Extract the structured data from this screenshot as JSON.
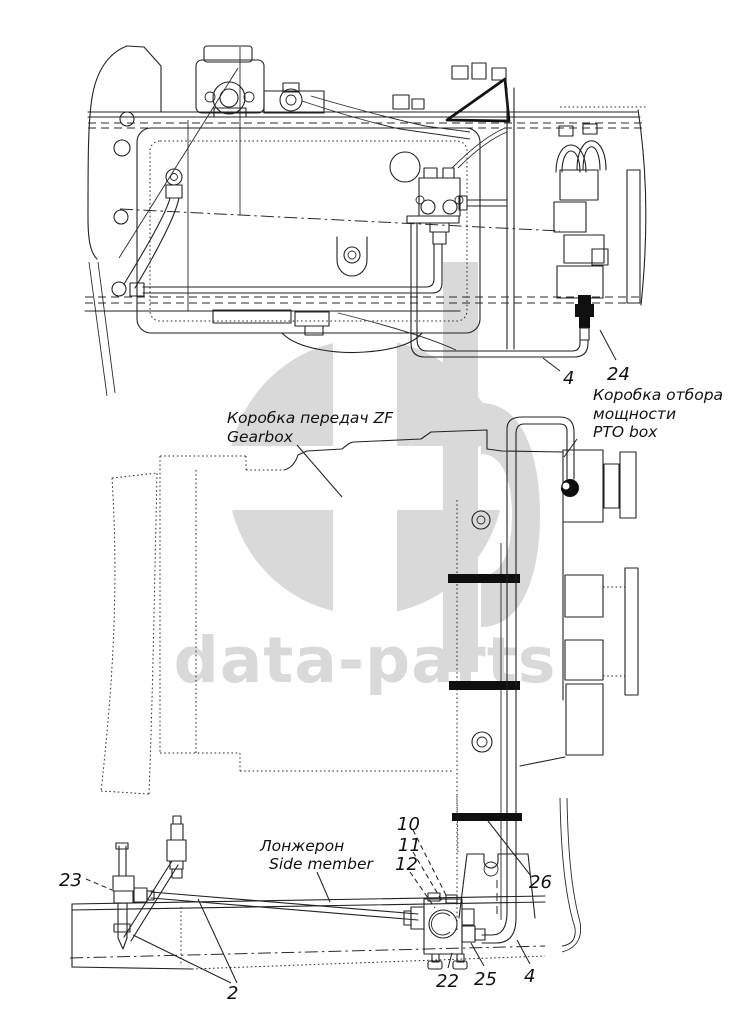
{
  "watermark": {
    "text": "data-parts"
  },
  "colors": {
    "line": "#222222",
    "clamp": "#0f0f0f",
    "watermark": "#d9d9d9",
    "background": "#ffffff"
  },
  "callouts": {
    "top_view": {
      "item_4": "4",
      "item_24": "24",
      "pto_label_ru_1": "Коробка отбора",
      "pto_label_ru_2": "мощности",
      "pto_label_en": "PTO box",
      "gearbox_label_ru": "Коробка передач ZF",
      "gearbox_label_en": "Gearbox"
    },
    "bottom_view": {
      "item_10": "10",
      "item_11": "11",
      "item_12": "12",
      "item_26": "26",
      "item_23": "23",
      "item_2": "2",
      "item_22": "22",
      "item_25": "25",
      "item_4": "4",
      "side_member_label_ru": "Лонжерон",
      "side_member_label_en": "Side member"
    }
  }
}
